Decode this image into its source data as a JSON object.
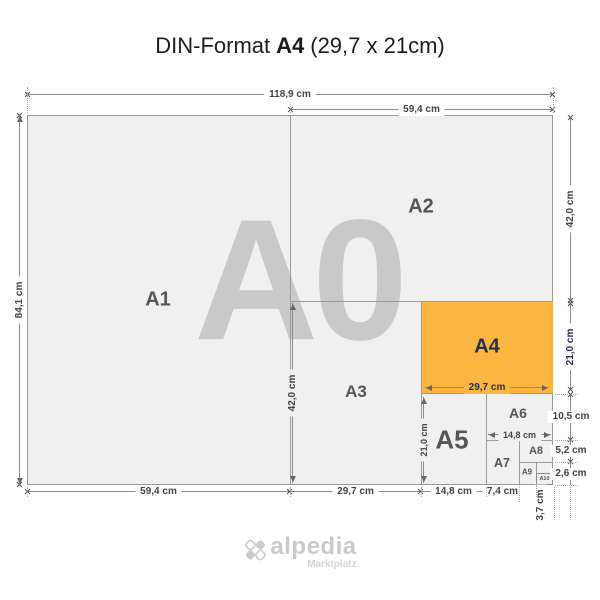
{
  "title": {
    "prefix": "DIN-Format",
    "emphasis": "A4",
    "suffix": "(29,7 x 21cm)"
  },
  "watermark_label": "A0",
  "papers": {
    "a1": "A1",
    "a2": "A2",
    "a3": "A3",
    "a4": "A4",
    "a5": "A5",
    "a6": "A6",
    "a7": "A7",
    "a8": "A8",
    "a9": "A9",
    "a10": "A10"
  },
  "dimensions": {
    "a0_width": "118,9 cm",
    "a0_height": "84,1 cm",
    "a1_width": "59,4 cm",
    "a2_width": "59,4 cm",
    "a2_height": "42,0 cm",
    "a3_width": "29,7 cm",
    "a3_height": "42,0 cm",
    "a4_width": "29,7 cm",
    "a4_height": "21,0 cm",
    "a5_width": "14,8 cm",
    "a5_height": "21,0 cm",
    "a6_width": "14,8 cm",
    "a6_height": "10,5 cm",
    "a7_width": "7,4 cm",
    "a8_height": "5,2 cm",
    "a9_width": "3,7 cm",
    "a10_height": "2,6 cm"
  },
  "logo": {
    "name": "alpedia",
    "tagline": "Marktplatz"
  },
  "colors": {
    "highlight_orange": "#FBB540",
    "navy_text": "#1E3150",
    "paper_fill": "#F0F0F0",
    "outline_gray": "#9A9A9A",
    "dimension_text": "#444444",
    "watermark_gray": "#C9C9C9",
    "label_gray": "#555555",
    "logo_gray": "#C9CACE"
  }
}
